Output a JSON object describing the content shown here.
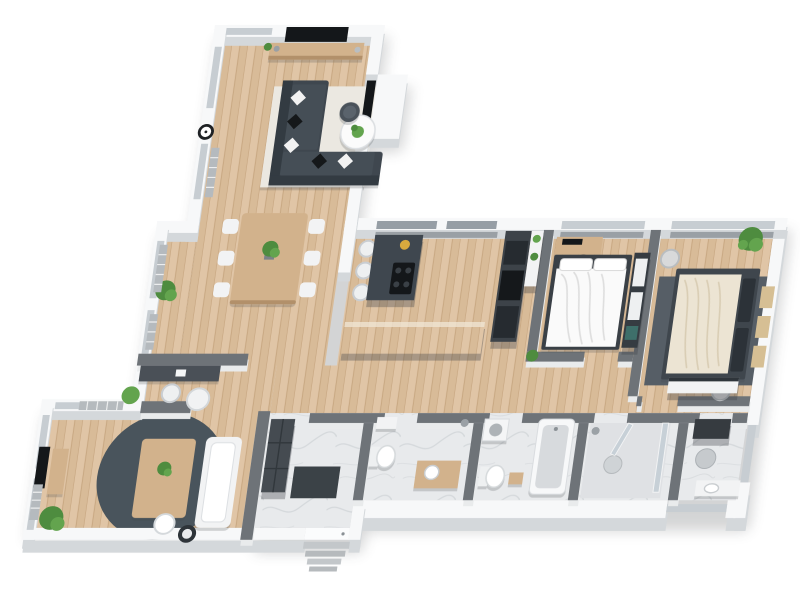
{
  "scene": {
    "type": "3d-floor-plan-render",
    "view": "isometric-top",
    "background": "white",
    "rooms": [
      {
        "id": "living-room",
        "furniture": [
          "sectional-sofa",
          "diamond-pillows",
          "coffee-table-round",
          "side-table-round",
          "area-rug-light",
          "tv-wall-mounted",
          "media-console",
          "wall-clock",
          "black-wall-panel",
          "radiator",
          "windows"
        ]
      },
      {
        "id": "dining-area",
        "furniture": [
          "dining-table-wood",
          "six-white-chairs",
          "table-plant",
          "corner-plant",
          "radiators",
          "windows"
        ]
      },
      {
        "id": "kitchen",
        "furniture": [
          "island-dark",
          "cooktop",
          "bar-stools",
          "tall-cabinet-appliances",
          "shelf-unit",
          "peninsula-counter"
        ]
      },
      {
        "id": "bedroom-1",
        "furniture": [
          "double-bed-white-duvet",
          "headboard-dark",
          "wardrobe-dark",
          "desk",
          "monitor",
          "office-chair",
          "plant"
        ]
      },
      {
        "id": "bedroom-2",
        "furniture": [
          "double-bed-cream-duvet",
          "dark-pillows",
          "area-rug-dark",
          "poufs",
          "plant",
          "wall-shelves",
          "dresser-white"
        ]
      },
      {
        "id": "hallway",
        "furniture": [
          "corridor-floor-wood"
        ]
      },
      {
        "id": "entry-hall",
        "furniture": [
          "wardrobe-tall-dark",
          "door-mat-dark",
          "entry-door",
          "exterior-steps"
        ]
      },
      {
        "id": "bathroom-1",
        "furniture": [
          "wall-sink",
          "toilet",
          "vanity-wood"
        ]
      },
      {
        "id": "bathroom-2",
        "furniture": [
          "bathtub",
          "toilet",
          "wood-stool",
          "washing-machine"
        ]
      },
      {
        "id": "shower-room",
        "furniture": [
          "glass-shower",
          "shower-head",
          "glass-door"
        ]
      },
      {
        "id": "bathroom-3",
        "furniture": [
          "ceiling-vent-dark",
          "shower-drain",
          "sink-counter"
        ]
      },
      {
        "id": "family-room",
        "furniture": [
          "round-rug-dark",
          "table-wood",
          "white-sofa",
          "ottoman-white",
          "side-table-dark",
          "tv-wall-mounted",
          "media-console",
          "plants",
          "radiators"
        ]
      },
      {
        "id": "office-nook",
        "furniture": [
          "desk-dark",
          "white-chair",
          "round-side-table"
        ]
      }
    ]
  },
  "palette": {
    "wall-top": "#f7f8f9",
    "wall-side": "#d4d8db",
    "iwall-top": "#6e7378",
    "iwall-side": "#e9ebec",
    "glass": "#c7cdd2",
    "glass-dark": "#969ea5",
    "pelmet": "#9aa0a5",
    "wood-a": "#e0c5a6",
    "wood-b": "#d8bb98",
    "wood-line": "#c6a57f",
    "marble-a": "#e8eaec",
    "marble-vein": "#d0d3d7",
    "dark-furn": "#3f474f",
    "black": "#14171a",
    "white-furn": "#f2f3f4",
    "wood-furn": "#d2b28c",
    "wood-furn-dark": "#b2906a",
    "plant-a": "#4e8c3f",
    "plant-b": "#63a44e",
    "radiator": "#b5babe",
    "rug-light": "#ebe8e1",
    "rug-dark": "#49545c",
    "rug-bed": "#565e66",
    "fabric-white": "#fafafa",
    "fabric-cream": "#ece4d3",
    "fold": "#dedede",
    "fold-cream": "#d9cdb4",
    "shadow": "#2a2e33"
  }
}
